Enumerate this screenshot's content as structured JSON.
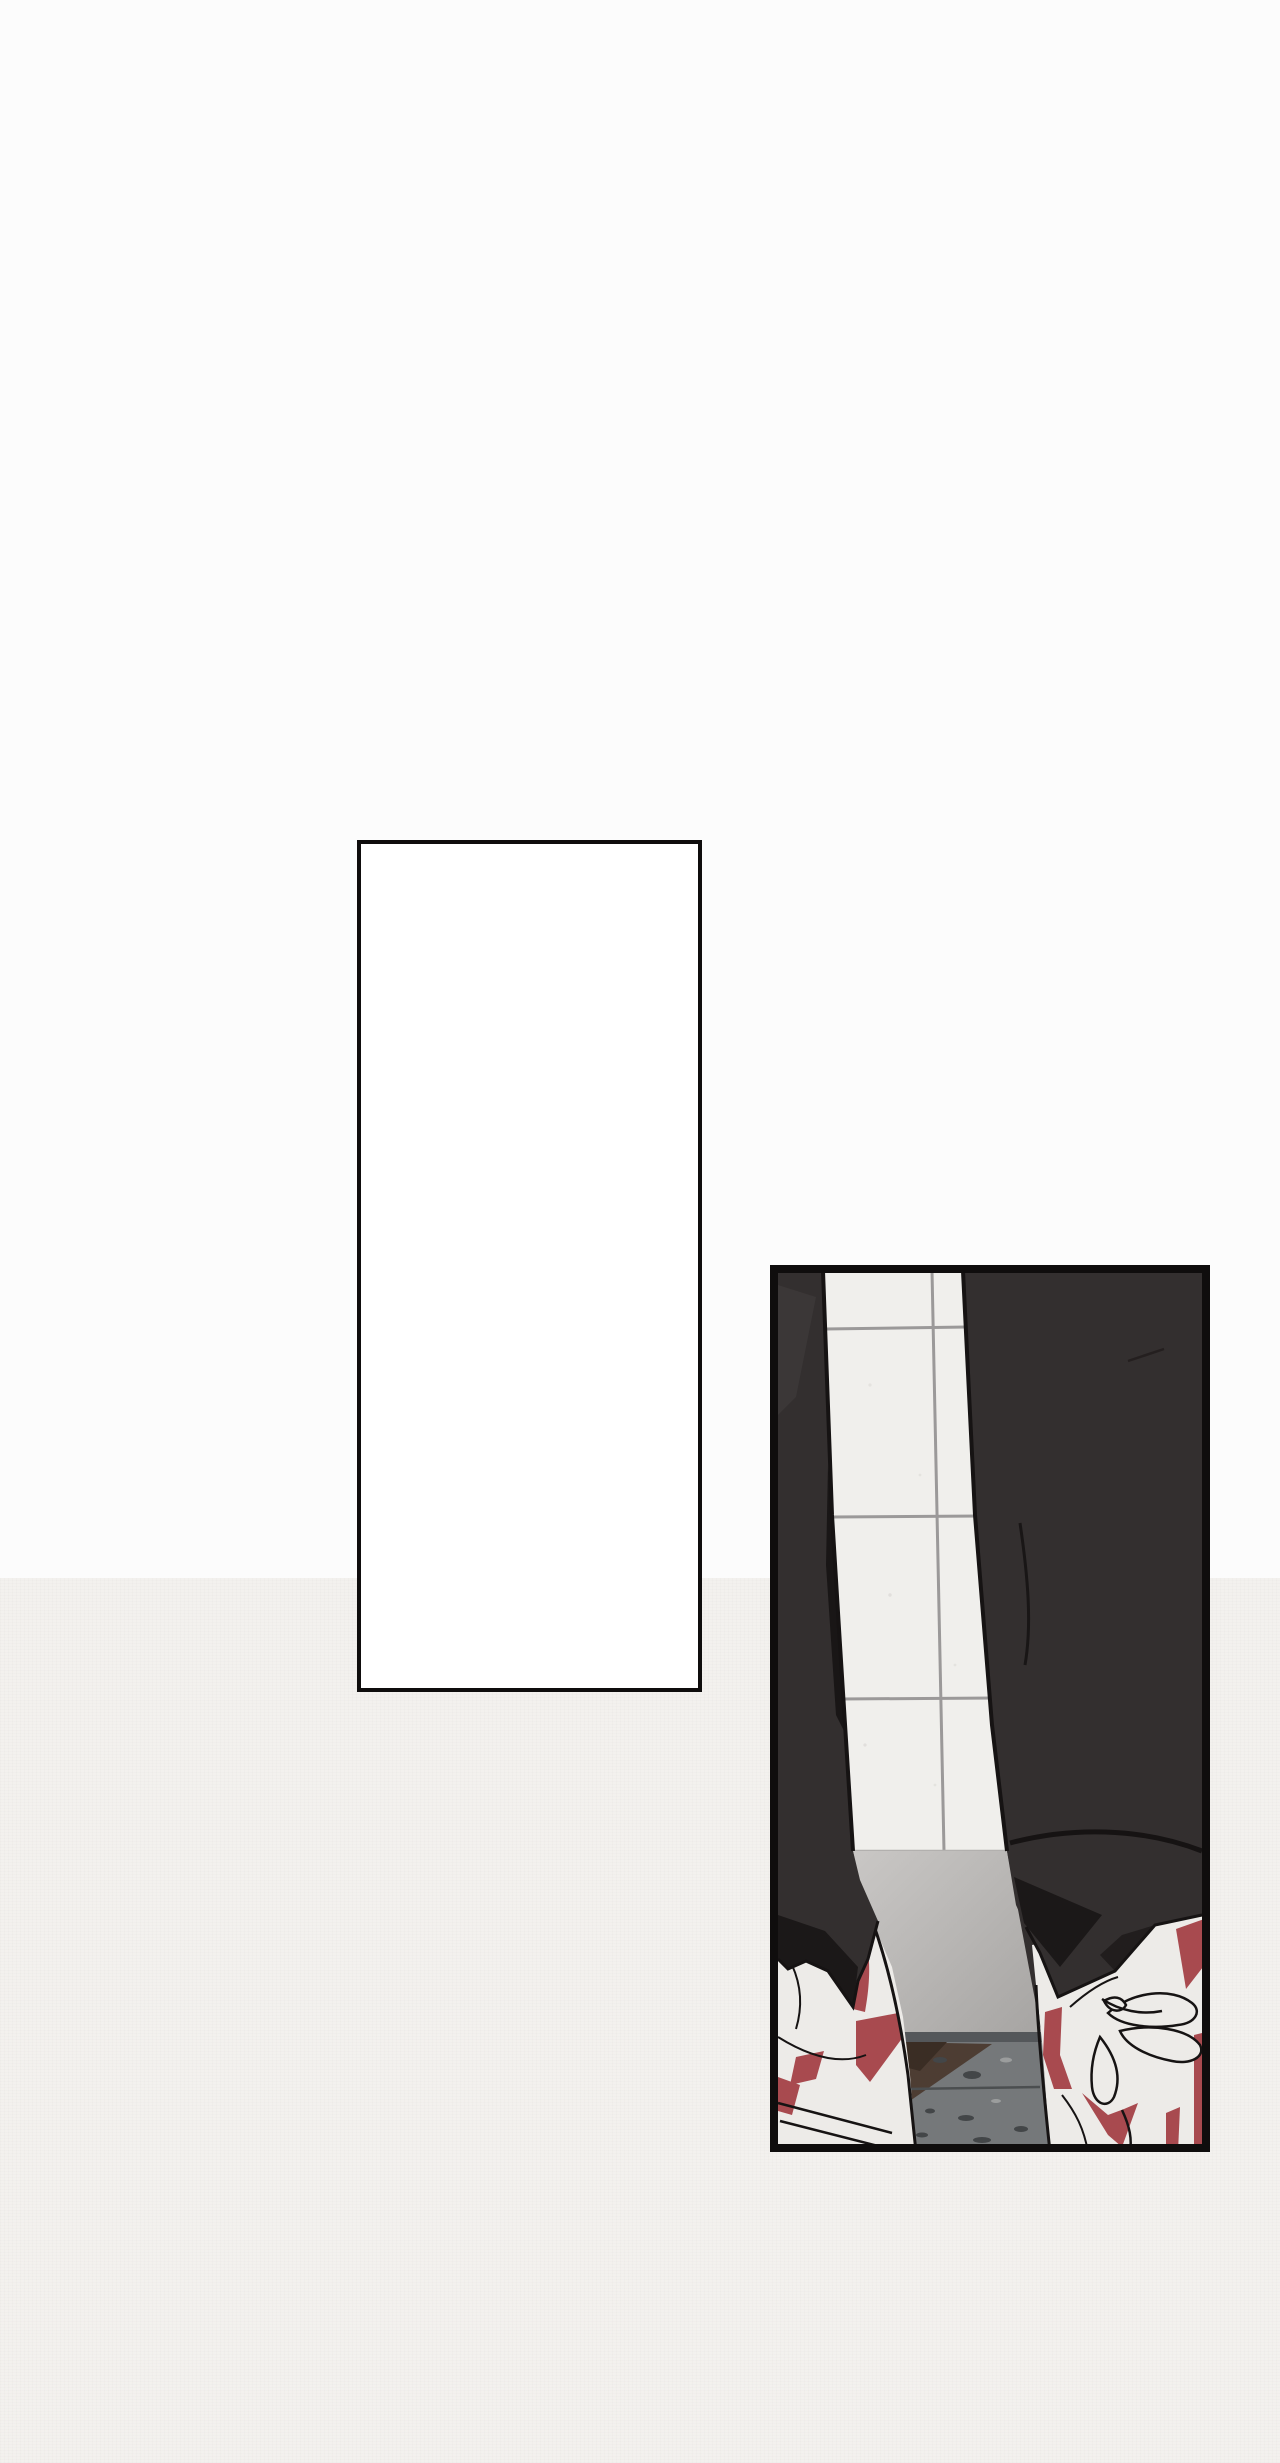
{
  "page": {
    "kind": "webtoon-page",
    "description": "Comic page with an empty bordered panel and a scene panel: two dark pant legs standing before a bright gridded window, white sneakers with red accents on a speckled stone floor.",
    "width_px": 1280,
    "height_px": 2463
  },
  "background": {
    "upper_color": "#fcfcfc",
    "lower_color": "#f3f1ee",
    "transition_y": 1578
  },
  "panels": [
    {
      "name": "empty-panel",
      "shape": "rectangle",
      "x": 357,
      "y": 840,
      "width": 345,
      "height": 852,
      "border_px": 4,
      "fill": "#ffffff",
      "content": "blank"
    },
    {
      "name": "scene-panel",
      "shape": "rectangle",
      "x": 770,
      "y": 1265,
      "width": 440,
      "height": 887,
      "border_px": 8,
      "scene_elements": [
        "window-pane with 3 horizontal and 1 vertical gray mullions",
        "left-pant-leg (dark)",
        "right-pant-leg (dark)",
        "light-gray floor",
        "floor seam band",
        "brown floor wedge",
        "speckled stone floor",
        "left-sneaker (white with red chevrons)",
        "right-sneaker (white with red stripes and laces)"
      ]
    }
  ],
  "palette": {
    "line": "#0f0d0d",
    "page-top": "#fcfcfc",
    "page-bottom": "#f3f1ee",
    "panel-white": "#ffffff",
    "pant": "#332f2f",
    "pant-dark": "#1b1818",
    "pant-hi": "#3b3737",
    "outline": "#161313",
    "window": "#f0efec",
    "mullion": "#9b9999",
    "sill": "#b2b0ae",
    "floor-a": "#c9c7c5",
    "floor-b": "#a6a4a2",
    "floor-seam": "#54575a",
    "floor-brown": "#4d3d33",
    "floor-brown-dark": "#3a2d24",
    "floor-gray": "#75787a",
    "speck-dark": "#434648",
    "speck-light": "#9b9d9d",
    "shoe": "#edebe8",
    "red": "#a84a4f"
  }
}
